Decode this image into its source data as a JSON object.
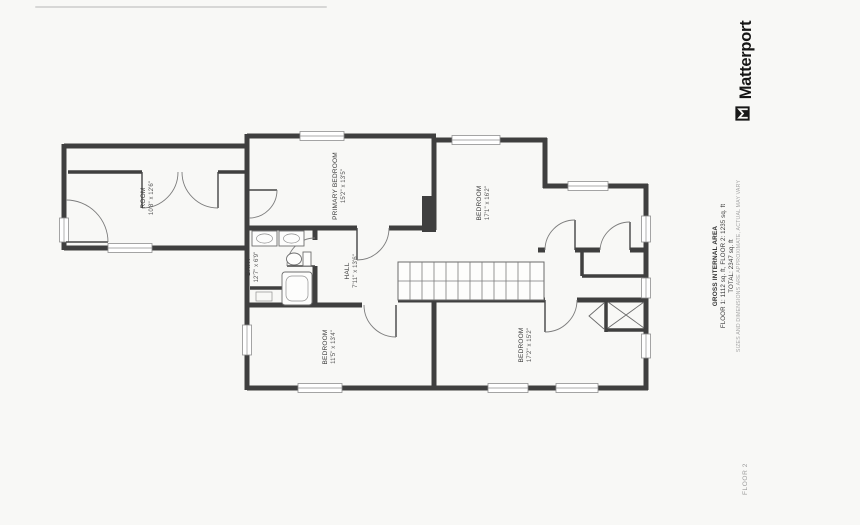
{
  "brand": {
    "logo_text": "Matterport",
    "logo_icon": "matterport-logo-icon"
  },
  "area_summary": {
    "title": "GROSS INTERNAL AREA",
    "floors_line": "FLOOR 1: 1112 sq. ft, FLOOR 2: 1235 sq. ft",
    "total_line": "TOTAL: 2347 sq. ft",
    "disclaimer": "SIZES AND DIMENSIONS ARE APPROXIMATE, ACTUAL MAY VARY"
  },
  "floor_label": "FLOOR 2",
  "rooms": [
    {
      "name": "ROOM",
      "dimensions": "10'8\" x 12'6\""
    },
    {
      "name": "PRIMARY BEDROOM",
      "dimensions": "15'2\" x 13'5\""
    },
    {
      "name": "BEDROOM",
      "dimensions": "17'1\" x 16'2\""
    },
    {
      "name": "BATH",
      "dimensions": "12'7\" x 6'9\""
    },
    {
      "name": "HALL",
      "dimensions": "7'11\" x 13'6\""
    },
    {
      "name": "BEDROOM",
      "dimensions": "11'5\" x 13'4\""
    },
    {
      "name": "BEDROOM",
      "dimensions": "17'2\" x 15'2\""
    }
  ],
  "colors": {
    "wall": "#3f3f3f",
    "paper": "#f8f8f6",
    "label": "#3c3c3c",
    "muted": "#9b9b9b"
  }
}
